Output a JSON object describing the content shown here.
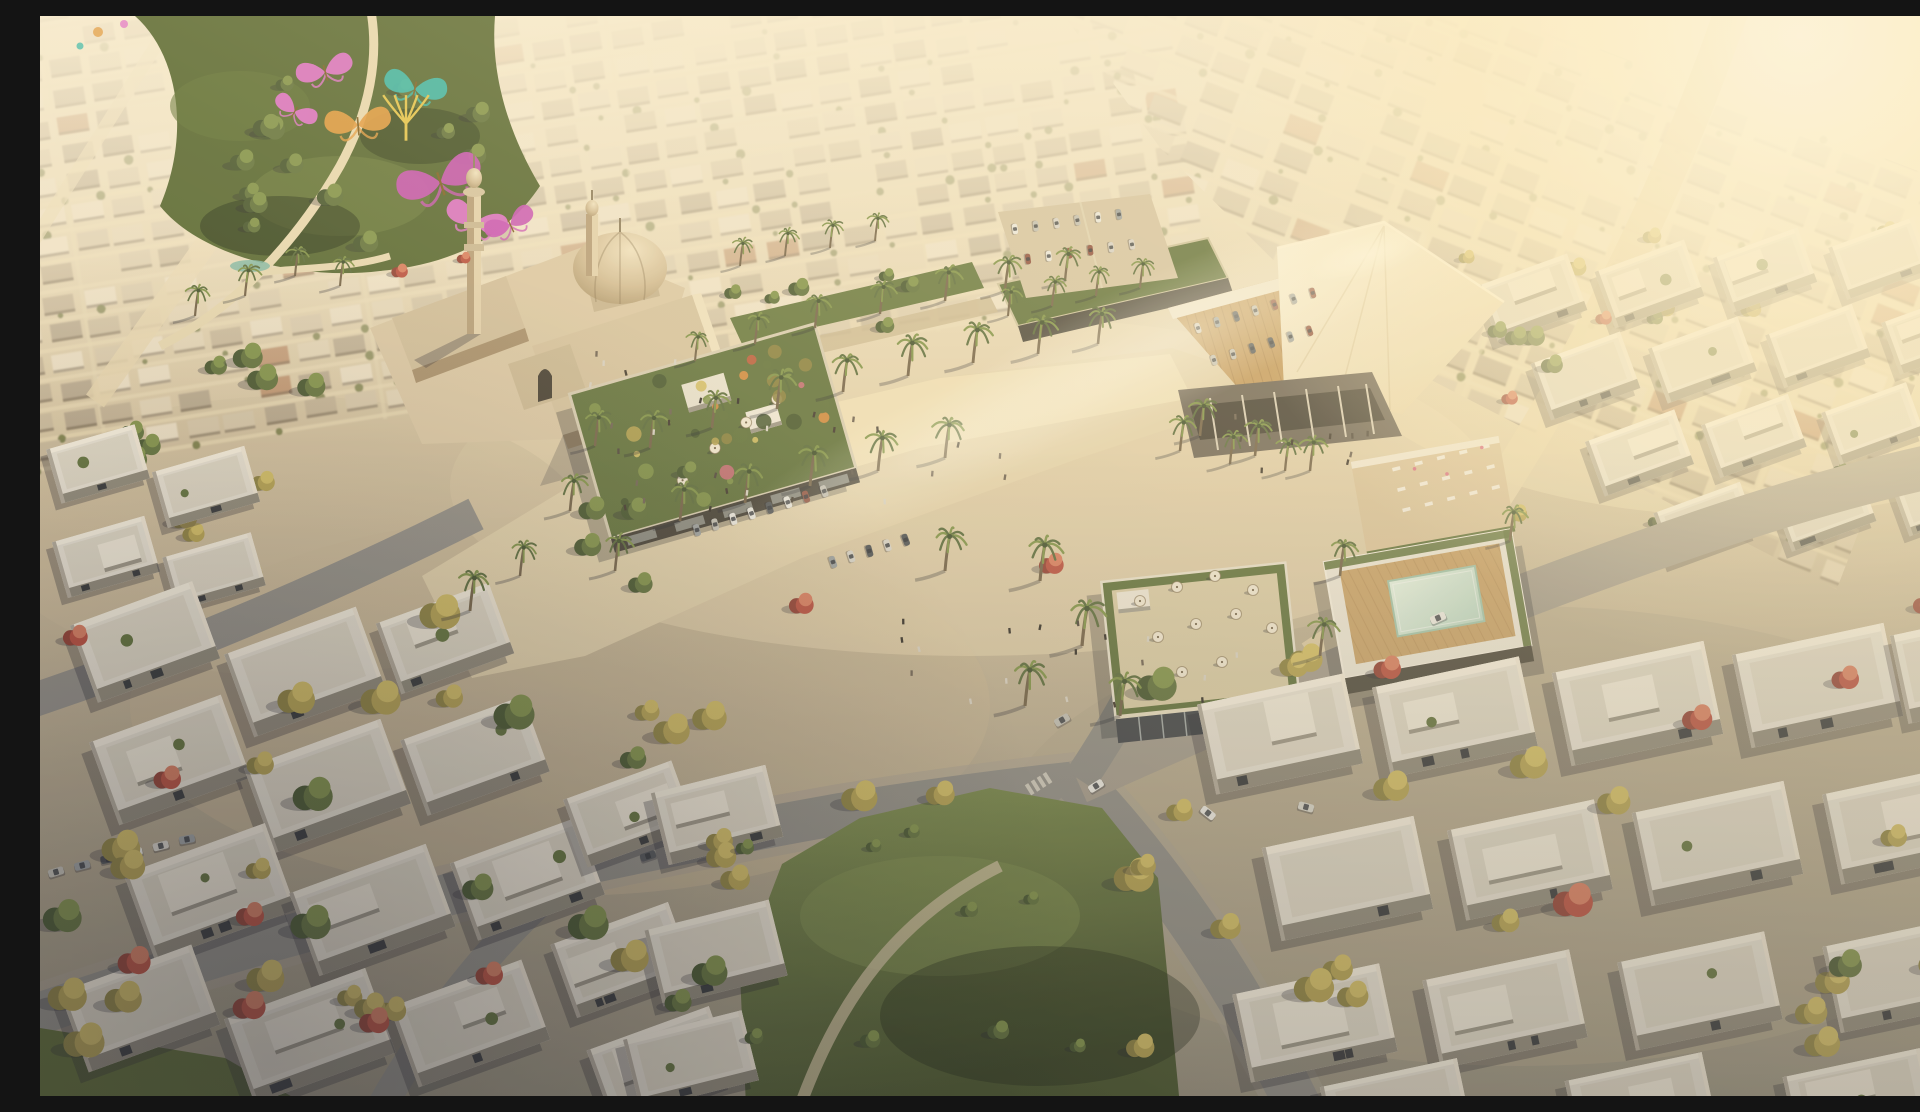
{
  "meta": {
    "title": "Aerial golden-hour rendering of a desert master-planned community with a mosque, butterfly sculpture park, palm-lined retail boulevard, rooftop pool and rows of flat-roofed villas",
    "width": 1920,
    "height": 1080
  },
  "palette": {
    "roofNeutrals": [
      "#ecdfc6",
      "#e2d3b6",
      "#d5c5a8",
      "#c9b99c",
      "#bfae92",
      "#b2a289"
    ],
    "roofAccent": "#b98a66",
    "streetLight": "#ead9b4",
    "treeGold": [
      "#8a7f3e",
      "#b3a04f",
      "#d2bd63"
    ],
    "treeGreen": [
      "#41522c",
      "#5d6f3a",
      "#7e9148"
    ],
    "treeRed": [
      "#8f3a30",
      "#b84a3c",
      "#d97a5e"
    ],
    "palmDark": "#56683a",
    "palmLight": "#7d9147",
    "palmTrunk": "#6f5e46",
    "villaWall": "#e8e2d5",
    "villaTop": "#f7f0e1",
    "villaRight": "#f2e9d8",
    "villaBottom": "#8d8779",
    "villaLeft": "#b1a99b",
    "villaInner": "#ded7c7",
    "villaBox": "#f0e9da",
    "window": "#2f3237",
    "carColors": [
      "#ecebe5",
      "#d8d5cd",
      "#c2c0b8",
      "#9aa0a3",
      "#4a4f55",
      "#8c4a3c"
    ],
    "peopleColors": [
      "#2e2a26",
      "#3b332b",
      "#4a423a",
      "#6b5f52",
      "#d8d2c6"
    ],
    "umbrella": "#f1e8d4",
    "lounger": "#f2ece0",
    "loungerAccent": "#d96a84",
    "shadow": "rgba(26,28,40,0.30)",
    "greenRoof": "#5c6e39",
    "deck": "#c49a5f",
    "sculptures": {
      "pink": "#e46fd0",
      "magenta": "#c94fb6",
      "teal": "#35b9ae",
      "orange": "#e3993f",
      "yellow": "#e4c34a"
    }
  },
  "scene": {
    "zones": [
      {
        "rot": -9,
        "ox": 0,
        "oy": 0,
        "x": -80,
        "y": -70,
        "w": 1180,
        "h": 500,
        "cw": 40,
        "rh": 29
      },
      {
        "rot": 21,
        "ox": 1400,
        "oy": 100,
        "x": 820,
        "y": -170,
        "w": 1280,
        "h": 560,
        "cw": 44,
        "rh": 32,
        "clip": "clipR"
      }
    ],
    "regions": [
      {
        "layer": "g-trees",
        "x": 10,
        "y": 575,
        "w": 560,
        "h": 460,
        "n": 22,
        "type": "mix",
        "s": [
          0.9,
          1.5
        ]
      },
      {
        "layer": "g-trees",
        "x": 565,
        "y": 690,
        "w": 350,
        "h": 350,
        "n": 12,
        "type": "mix",
        "s": [
          0.9,
          1.4
        ]
      },
      {
        "layer": "g-trees",
        "x": 1090,
        "y": 610,
        "w": 810,
        "h": 430,
        "n": 22,
        "type": "mix",
        "s": [
          0.9,
          1.5
        ]
      },
      {
        "layer": "g-midright",
        "x": 1405,
        "y": 200,
        "w": 500,
        "h": 330,
        "n": 16,
        "type": "mix",
        "s": [
          0.5,
          0.8
        ]
      },
      {
        "layer": "g-park-extra",
        "x": 10,
        "y": 335,
        "w": 330,
        "h": 225,
        "n": 12,
        "type": "greenmix",
        "s": [
          0.8,
          1.2
        ]
      },
      {
        "layer": "g-trees",
        "x": 455,
        "y": 435,
        "w": 210,
        "h": 145,
        "n": 5,
        "type": "green",
        "s": [
          0.7,
          1.0
        ]
      },
      {
        "layer": "g-trees",
        "x": 705,
        "y": 805,
        "w": 370,
        "h": 230,
        "n": 9,
        "type": "green",
        "s": [
          0.5,
          0.8
        ]
      },
      {
        "layer": "g-park-extra",
        "x": 150,
        "y": 45,
        "w": 300,
        "h": 185,
        "n": 14,
        "type": "green",
        "s": [
          0.6,
          1.0
        ]
      },
      {
        "layer": "g-band",
        "x": 660,
        "y": 252,
        "w": 420,
        "h": 66,
        "n": 10,
        "type": "green",
        "s": [
          0.5,
          0.8
        ]
      },
      {
        "layer": "g-canopy-extra",
        "x": 1380,
        "y": 300,
        "w": 150,
        "h": 90,
        "n": 4,
        "type": "green",
        "s": [
          0.6,
          0.9
        ]
      }
    ],
    "redTrees": [
      [
        95,
        945,
        1.2
      ],
      [
        210,
        990,
        1.2
      ],
      [
        335,
        1005,
        1.1
      ],
      [
        450,
        958,
        1.0
      ],
      [
        128,
        762,
        1.0
      ],
      [
        36,
        620,
        0.9
      ],
      [
        762,
        588,
        0.9
      ],
      [
        1012,
        548,
        0.9
      ],
      [
        1348,
        652,
        1.0
      ],
      [
        1658,
        702,
        1.1
      ],
      [
        1806,
        662,
        1.0
      ],
      [
        1564,
        302,
        0.6
      ],
      [
        1470,
        382,
        0.6
      ],
      [
        1886,
        588,
        0.9
      ],
      [
        360,
        255,
        0.6
      ],
      [
        424,
        242,
        0.5
      ]
    ],
    "villaClusters": [
      {
        "layer": "g-villas",
        "rot": -20,
        "items": [
          [
            40,
            585,
            130,
            82
          ],
          [
            195,
            612,
            140,
            88
          ],
          [
            345,
            585,
            120,
            75
          ],
          [
            60,
            700,
            140,
            88
          ],
          [
            215,
            725,
            145,
            90
          ],
          [
            370,
            700,
            130,
            80
          ],
          [
            95,
            830,
            150,
            92
          ],
          [
            260,
            850,
            145,
            88
          ],
          [
            420,
            822,
            135,
            82
          ],
          [
            30,
            950,
            140,
            85
          ],
          [
            195,
            975,
            150,
            90
          ],
          [
            360,
            965,
            140,
            85
          ],
          [
            520,
            905,
            125,
            78
          ],
          [
            532,
            762,
            115,
            72
          ],
          [
            556,
            1010,
            130,
            78
          ]
        ]
      },
      {
        "layer": "g-villas",
        "rot": -14,
        "items": [
          [
            618,
            762,
            118,
            74
          ],
          [
            612,
            898,
            128,
            78
          ],
          [
            590,
            1008,
            122,
            72
          ]
        ]
      },
      {
        "layer": "g-villas",
        "rot": -12,
        "items": [
          [
            1165,
            672,
            150,
            92
          ],
          [
            1340,
            655,
            150,
            92
          ],
          [
            1520,
            640,
            155,
            95
          ],
          [
            1700,
            622,
            155,
            95
          ],
          [
            1858,
            608,
            105,
            90
          ],
          [
            1230,
            815,
            155,
            95
          ],
          [
            1415,
            798,
            150,
            92
          ],
          [
            1600,
            780,
            155,
            95
          ],
          [
            1790,
            762,
            150,
            92
          ],
          [
            1200,
            962,
            150,
            90
          ],
          [
            1390,
            948,
            150,
            90
          ],
          [
            1585,
            930,
            150,
            90
          ],
          [
            1790,
            915,
            145,
            88
          ],
          [
            1285,
            1056,
            140,
            64
          ],
          [
            1530,
            1050,
            140,
            66
          ],
          [
            1748,
            1046,
            140,
            66
          ]
        ]
      },
      {
        "layer": "g-midright",
        "rot": -20,
        "items": [
          [
            1445,
            252,
            95,
            60
          ],
          [
            1562,
            238,
            95,
            60
          ],
          [
            1680,
            225,
            90,
            58
          ],
          [
            1795,
            215,
            90,
            55
          ],
          [
            1498,
            330,
            95,
            60
          ],
          [
            1615,
            315,
            95,
            58
          ],
          [
            1732,
            302,
            92,
            56
          ],
          [
            1848,
            290,
            90,
            55
          ],
          [
            1552,
            408,
            95,
            58
          ],
          [
            1668,
            392,
            92,
            56
          ],
          [
            1788,
            380,
            90,
            55
          ],
          [
            1620,
            480,
            92,
            55
          ],
          [
            1740,
            468,
            90,
            54
          ],
          [
            1858,
            455,
            88,
            52
          ]
        ]
      },
      {
        "layer": "g-band",
        "rot": -16,
        "items": [
          [
            12,
            420,
            92,
            56
          ],
          [
            118,
            442,
            96,
            58
          ],
          [
            18,
            512,
            96,
            58
          ],
          [
            128,
            528,
            92,
            55
          ]
        ]
      }
    ],
    "palms": [
      [
        655,
        345,
        0.8
      ],
      [
        715,
        328,
        0.85
      ],
      [
        775,
        312,
        0.9
      ],
      [
        840,
        298,
        0.9
      ],
      [
        905,
        285,
        0.95
      ],
      [
        965,
        275,
        0.95
      ],
      [
        1025,
        265,
        0.9
      ],
      [
        610,
        432,
        1.0
      ],
      [
        672,
        412,
        1.0
      ],
      [
        737,
        393,
        1.05
      ],
      [
        803,
        376,
        1.05
      ],
      [
        868,
        360,
        1.1
      ],
      [
        933,
        347,
        1.1
      ],
      [
        998,
        338,
        1.05
      ],
      [
        1058,
        328,
        1.0
      ],
      [
        640,
        505,
        1.05
      ],
      [
        705,
        487,
        1.05
      ],
      [
        770,
        470,
        1.1
      ],
      [
        838,
        455,
        1.1
      ],
      [
        905,
        442,
        1.1
      ],
      [
        1000,
        565,
        1.2
      ],
      [
        1042,
        630,
        1.25
      ],
      [
        985,
        690,
        1.2
      ],
      [
        1080,
        700,
        1.15
      ],
      [
        1160,
        420,
        1.0
      ],
      [
        1215,
        440,
        1.0
      ],
      [
        1270,
        455,
        0.95
      ],
      [
        1300,
        560,
        1.0
      ],
      [
        1280,
        640,
        1.05
      ],
      [
        1470,
        525,
        0.95
      ],
      [
        1140,
        435,
        0.95
      ],
      [
        1190,
        448,
        0.9
      ],
      [
        1245,
        455,
        0.9
      ],
      [
        968,
        300,
        0.8
      ],
      [
        1012,
        290,
        0.8
      ],
      [
        1056,
        280,
        0.8
      ],
      [
        1100,
        272,
        0.8
      ],
      [
        555,
        430,
        0.95
      ],
      [
        530,
        495,
        1.0
      ],
      [
        575,
        555,
        1.0
      ],
      [
        480,
        560,
        0.95
      ],
      [
        700,
        250,
        0.75
      ],
      [
        745,
        240,
        0.75
      ],
      [
        790,
        232,
        0.75
      ],
      [
        835,
        225,
        0.75
      ],
      [
        255,
        260,
        0.8
      ],
      [
        300,
        270,
        0.8
      ],
      [
        205,
        280,
        0.85
      ],
      [
        155,
        300,
        0.85
      ],
      [
        430,
        595,
        1.1
      ],
      [
        905,
        555,
        1.15
      ]
    ],
    "parkedRows": [
      {
        "x": 657,
        "y": 514,
        "a": -17,
        "n": 8,
        "g": 19,
        "s": 0.8,
        "perp": 1
      },
      {
        "x": 793,
        "y": 546,
        "a": -17,
        "n": 5,
        "g": 19,
        "s": 0.8,
        "perp": 1
      },
      {
        "x": 16,
        "y": 856,
        "a": -14,
        "n": 6,
        "g": 27,
        "s": 1.05,
        "perp": 0
      },
      {
        "x": 975,
        "y": 213,
        "a": -8,
        "n": 6,
        "g": 21,
        "s": 0.7,
        "perp": 1
      },
      {
        "x": 988,
        "y": 243,
        "a": -8,
        "n": 6,
        "g": 21,
        "s": 0.7,
        "perp": 1
      },
      {
        "x": 1158,
        "y": 312,
        "a": -17,
        "n": 7,
        "g": 20,
        "s": 0.7,
        "perp": 1
      },
      {
        "x": 1174,
        "y": 344,
        "a": -17,
        "n": 6,
        "g": 20,
        "s": 0.7,
        "perp": 1
      }
    ],
    "cars": [
      [
        1056,
        770,
        -32,
        0
      ],
      [
        1168,
        797,
        38,
        0
      ],
      [
        1266,
        791,
        15,
        1
      ],
      [
        1022,
        704,
        -30,
        2
      ],
      [
        1398,
        602,
        -24,
        0
      ],
      [
        608,
        840,
        -18,
        4
      ]
    ],
    "people": [
      {
        "x": 560,
        "y": 372,
        "w": 420,
        "h": 165,
        "n": 24
      },
      {
        "x": 860,
        "y": 600,
        "w": 380,
        "h": 100,
        "n": 18
      },
      {
        "x": 505,
        "y": 335,
        "w": 140,
        "h": 85,
        "n": 7
      },
      {
        "x": 1125,
        "y": 398,
        "w": 215,
        "h": 55,
        "n": 9
      }
    ],
    "umbrellasA": [
      [
        655,
        470
      ],
      [
        692,
        454
      ],
      [
        728,
        440
      ],
      [
        615,
        492
      ]
    ],
    "umbrellasB": [
      [
        1100,
        585
      ],
      [
        1137,
        571
      ],
      [
        1175,
        560
      ],
      [
        1213,
        574
      ],
      [
        1118,
        621
      ],
      [
        1156,
        608
      ],
      [
        1196,
        598
      ],
      [
        1232,
        612
      ],
      [
        1142,
        656
      ],
      [
        1182,
        646
      ]
    ],
    "roofDots": {
      "rect": [
        545,
        390,
        225,
        130
      ],
      "n": 36
    },
    "loungerGrid": {
      "x": 1352,
      "y": 452,
      "a": -14,
      "rows": 3,
      "cols": 5,
      "dx": 23,
      "dy": 21
    },
    "butterflies": [
      {
        "x": 285,
        "y": 55,
        "s": 1.0,
        "r": -15,
        "c": "pink"
      },
      {
        "x": 375,
        "y": 72,
        "s": 1.1,
        "r": 12,
        "c": "teal"
      },
      {
        "x": 318,
        "y": 108,
        "s": 1.15,
        "r": -5,
        "c": "orange"
      },
      {
        "x": 366,
        "y": 100,
        "s": 0.95,
        "r": 0,
        "c": "yellow"
      },
      {
        "x": 400,
        "y": 165,
        "s": 1.5,
        "r": -18,
        "c": "magenta"
      },
      {
        "x": 436,
        "y": 205,
        "s": 1.1,
        "r": 20,
        "c": "pink"
      },
      {
        "x": 470,
        "y": 208,
        "s": 0.9,
        "r": -25,
        "c": "magenta"
      },
      {
        "x": 255,
        "y": 95,
        "s": 0.8,
        "r": 30,
        "c": "pink"
      }
    ]
  }
}
